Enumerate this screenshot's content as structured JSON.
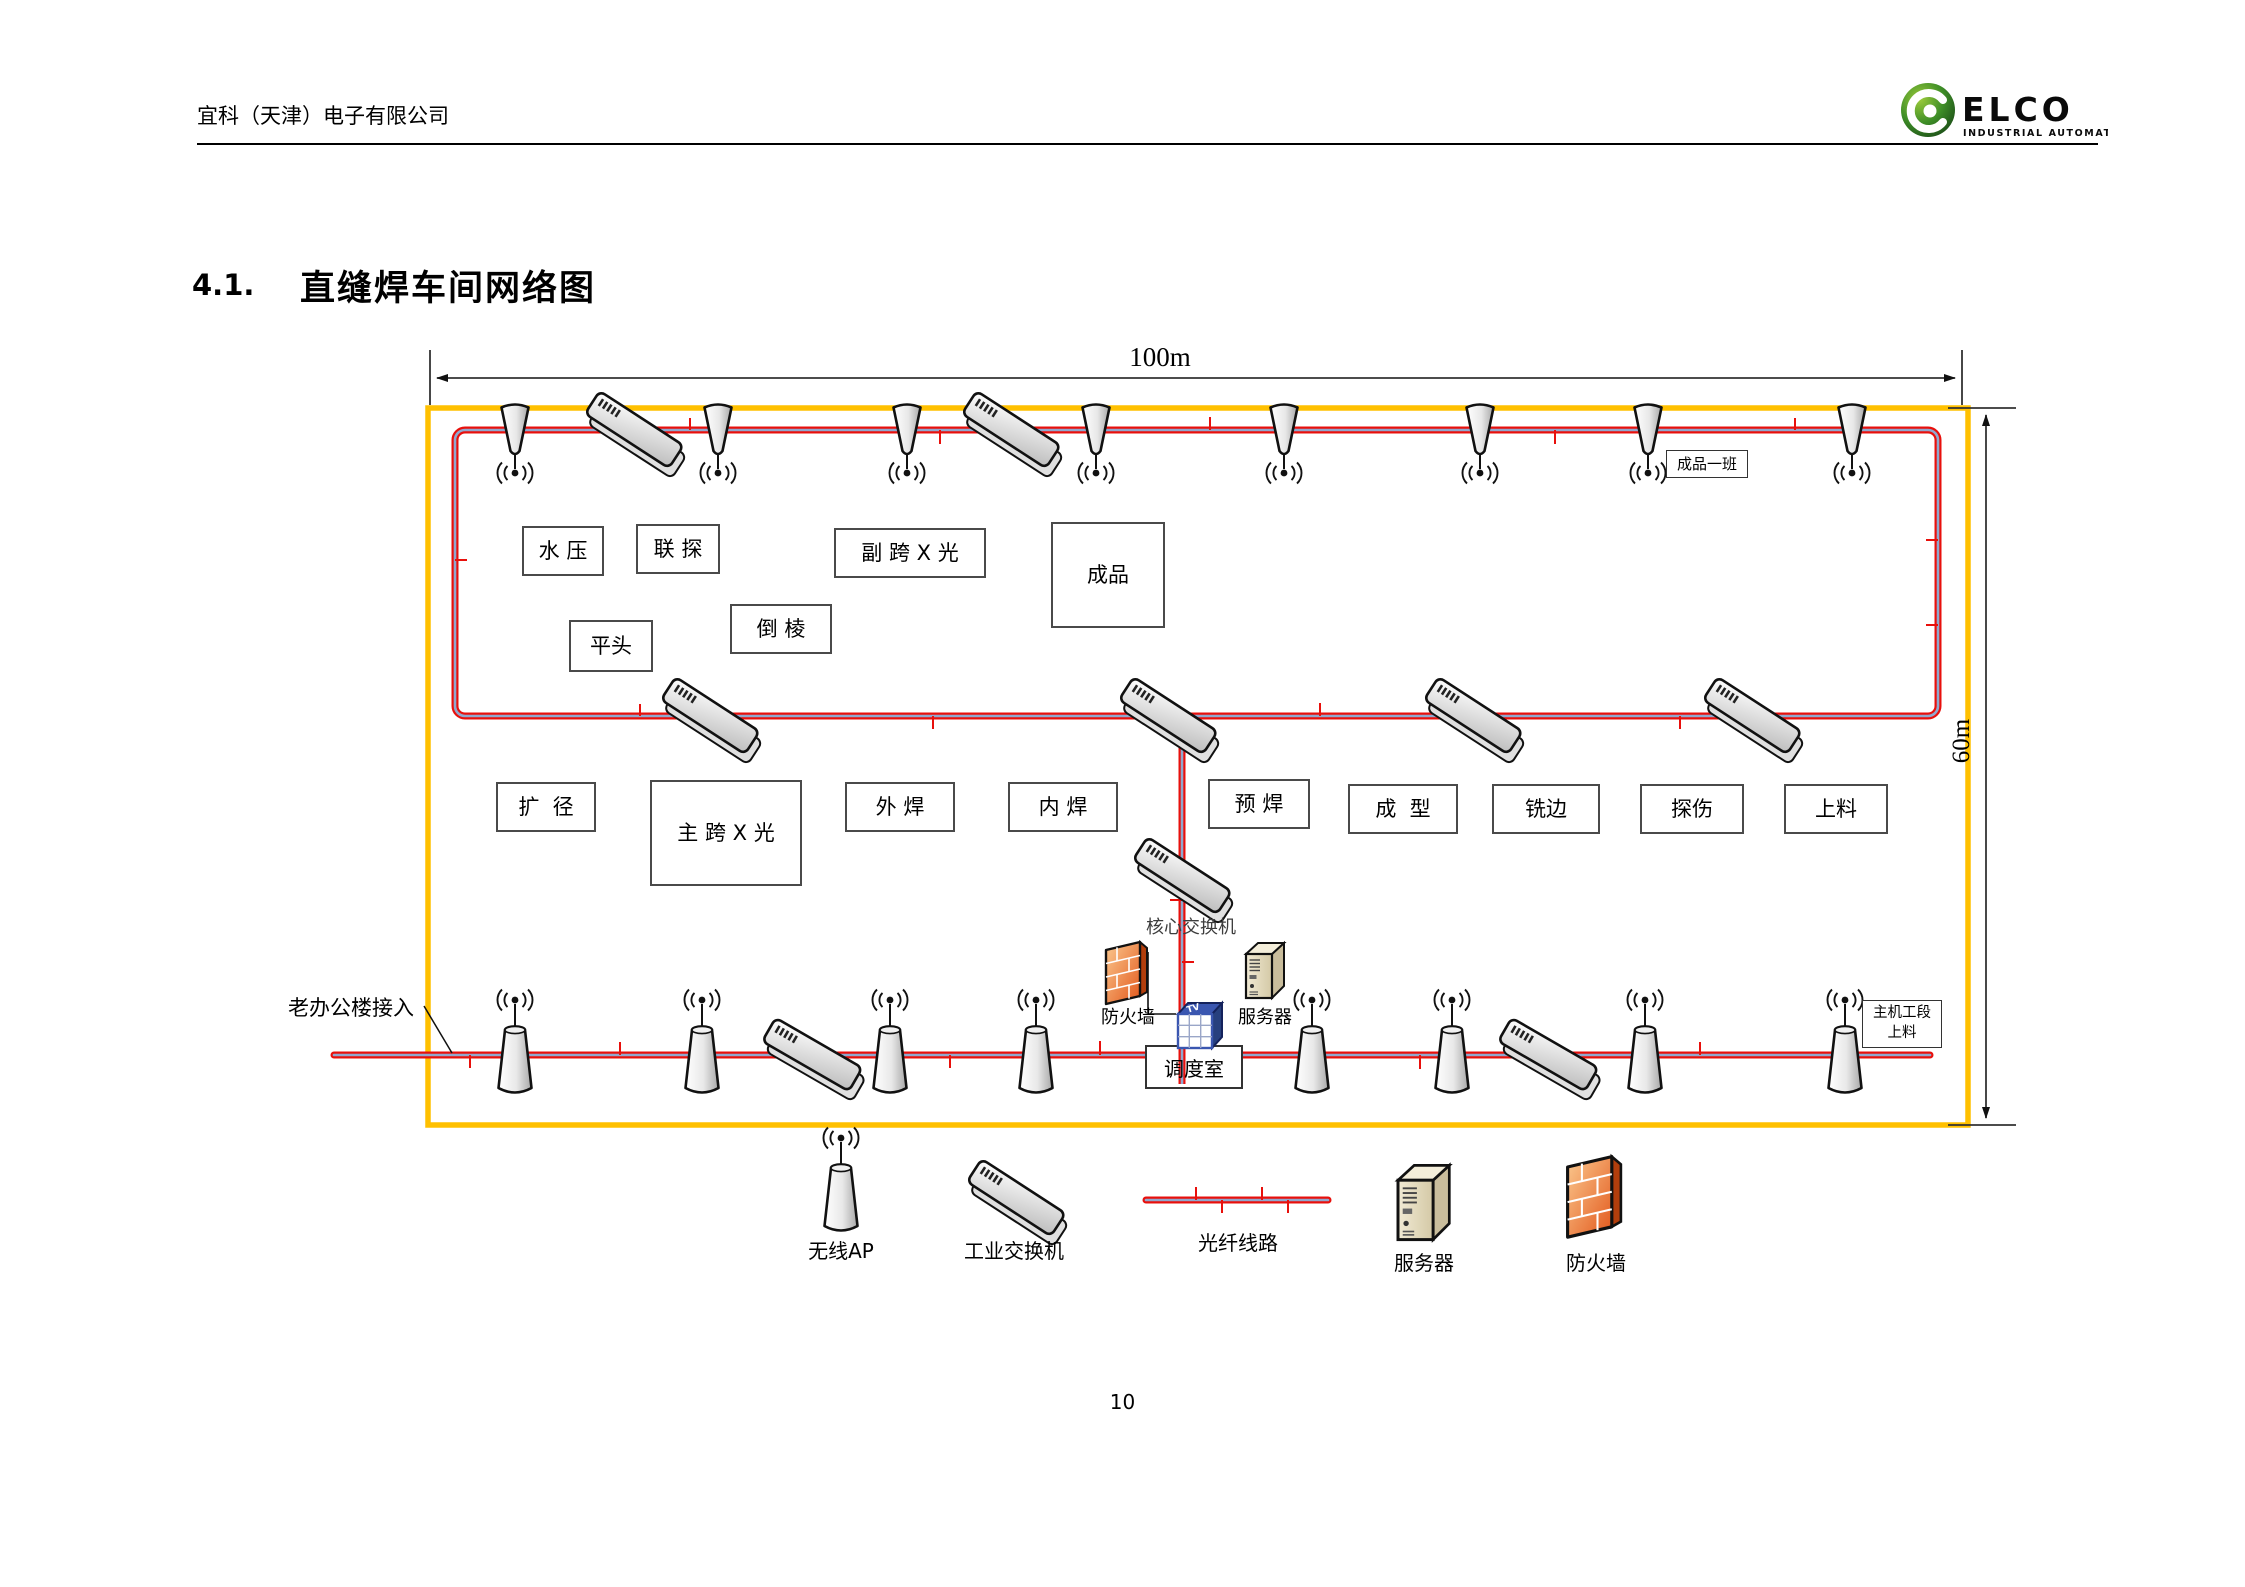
{
  "page": {
    "number": "10"
  },
  "header": {
    "company": "宜科（天津）电子有限公司",
    "logo": {
      "brand": "ELCO",
      "tagline": "INDUSTRIAL AUTOMATION"
    }
  },
  "section": {
    "number": "4.1.",
    "title": "直缝焊车间网络图"
  },
  "diagram": {
    "dimensions": {
      "width": "100m",
      "height": "60m"
    },
    "labels": {
      "finished_team": "成品一班",
      "office_access": "老办公楼接入",
      "core_switch": "核心交换机",
      "firewall": "防火墙",
      "server": "服务器",
      "dispatch_room": "调度室",
      "host_section_line1": "主机工段",
      "host_section_line2": "上料",
      "device_tag": "TV"
    },
    "stations": [
      {
        "label": "水 压"
      },
      {
        "label": "联 探"
      },
      {
        "label": "副 跨 X 光"
      },
      {
        "label": "成品"
      },
      {
        "label": "倒 棱"
      },
      {
        "label": "平头"
      },
      {
        "label": "扩  径"
      },
      {
        "label": "主 跨 X 光"
      },
      {
        "label": "外 焊"
      },
      {
        "label": "内 焊"
      },
      {
        "label": "预 焊"
      },
      {
        "label": "成  型"
      },
      {
        "label": "铣边"
      },
      {
        "label": "探伤"
      },
      {
        "label": "上料"
      }
    ]
  },
  "legend": {
    "items": [
      {
        "label": "无线AP"
      },
      {
        "label": "工业交换机"
      },
      {
        "label": "光纤线路"
      },
      {
        "label": "服务器"
      },
      {
        "label": "防火墙"
      }
    ]
  },
  "colors": {
    "wall_outline": "#FFC000",
    "fiber_red": "#E8100C",
    "fiber_core": "#90A8CE",
    "logo_green": "#2E7D32"
  }
}
